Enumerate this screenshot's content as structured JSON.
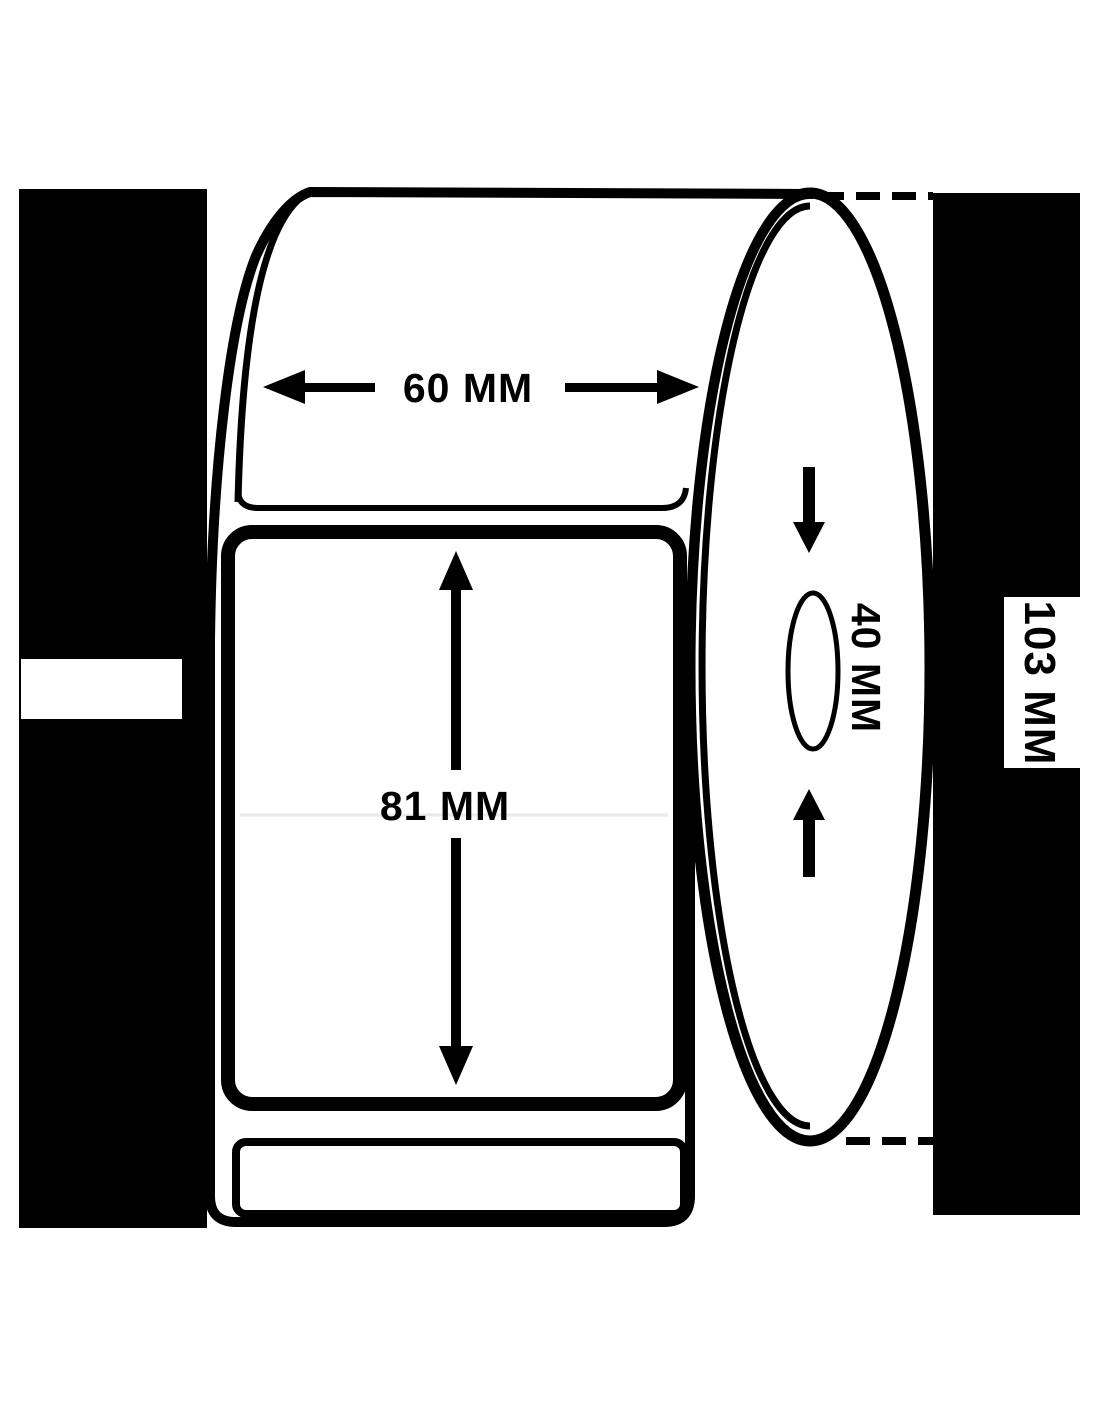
{
  "page": {
    "colors": {
      "ink": "#000000",
      "background": "#ffffff"
    }
  },
  "diagram": {
    "type": "technical-dimension-diagram",
    "subject": "label roll with unwound label strip, side cylinder view and core",
    "dimensions": {
      "label_width": "60 MM",
      "label_height": "81 MM",
      "core_diameter": "40 MM",
      "roll_diameter": "103 MM"
    }
  }
}
